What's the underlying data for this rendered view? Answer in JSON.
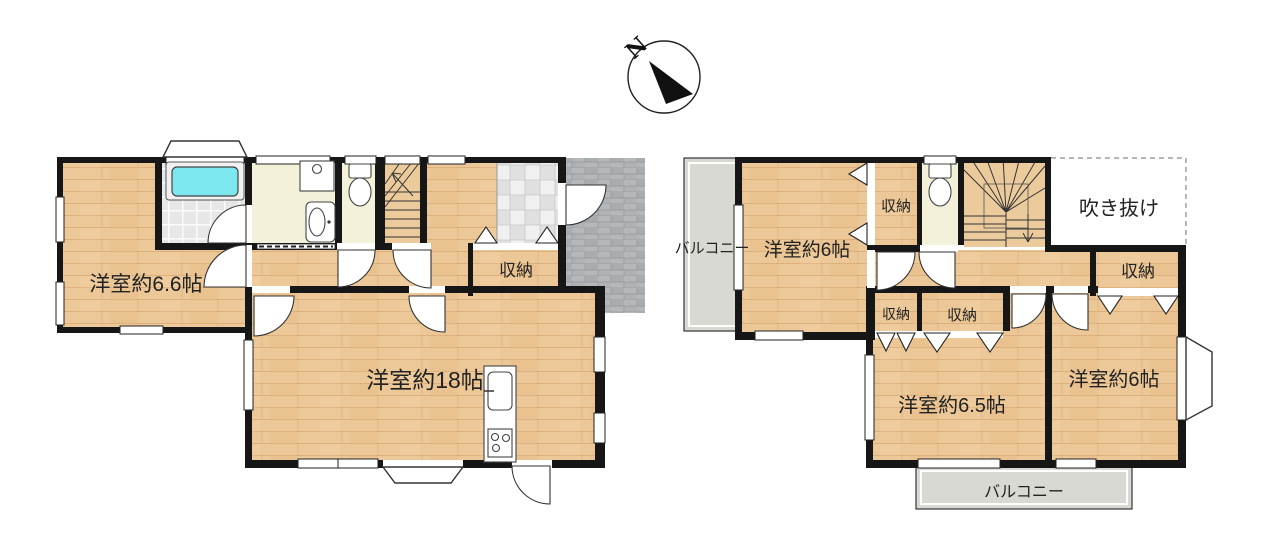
{
  "compass": {
    "label": "N"
  },
  "floor1": {
    "rooms": {
      "western_room_6_6": "洋室約6.6帖",
      "western_room_18": "洋室約18帖",
      "closet": "収納"
    }
  },
  "floor2": {
    "rooms": {
      "balcony_left": "バルコニー",
      "western_room_6_nw": "洋室約6帖",
      "closet_upper": "収納",
      "atrium": "吹き抜け",
      "closet_hall": "収納",
      "closet_small_a": "収納",
      "closet_small_b": "収納",
      "western_room_6_5": "洋室約6.5帖",
      "western_room_6_se": "洋室約6帖",
      "balcony_bottom": "バルコニー"
    }
  },
  "colors": {
    "wood": "#ecc797",
    "wood_line": "#d7a771",
    "tan": "#ebcb9c",
    "pale": "#f4f1da",
    "bath_tile": "#e7e7e7",
    "genkan_a": "#f0f0f0",
    "genkan_b": "#e0e0e0",
    "porch": "#b5b8bb",
    "porch_line": "#9a9da0",
    "balcony": "#d9d9d4",
    "tub": "#7de7ef",
    "wall": "#161616",
    "label": "#222222"
  }
}
